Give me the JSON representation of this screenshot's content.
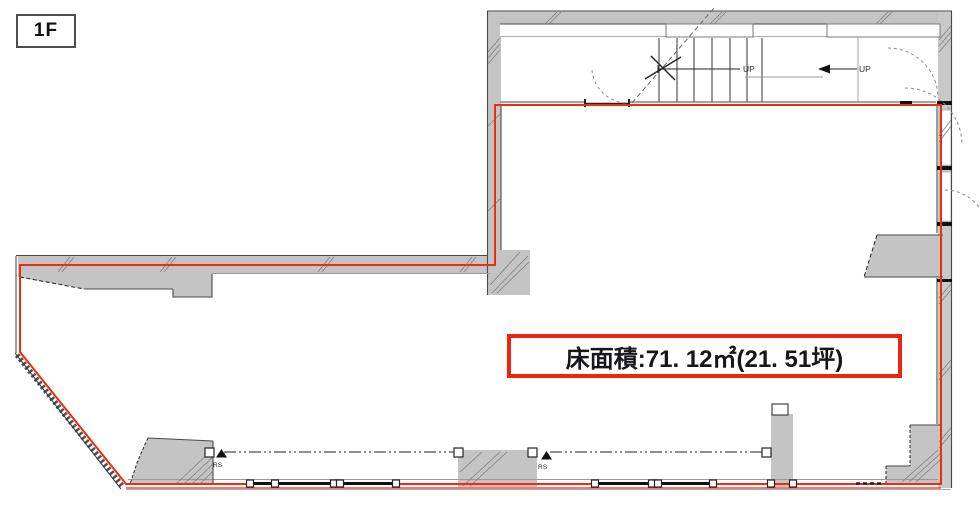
{
  "floor_badge": {
    "label": "1F"
  },
  "area_box": {
    "label": "床面積:71. 12㎡(21. 51坪)"
  },
  "annotations": {
    "up_main_stairs": "UP",
    "up_right": "UP",
    "shutter_marker_left": "RS",
    "shutter_marker_center": "RS"
  },
  "colors": {
    "tenancy_boundary": "#ef2c12",
    "area_box_border": "#ee2410",
    "wall_fill": "#c4c4c4",
    "wall_line": "#4a4a4a",
    "detail_line": "#222222"
  }
}
